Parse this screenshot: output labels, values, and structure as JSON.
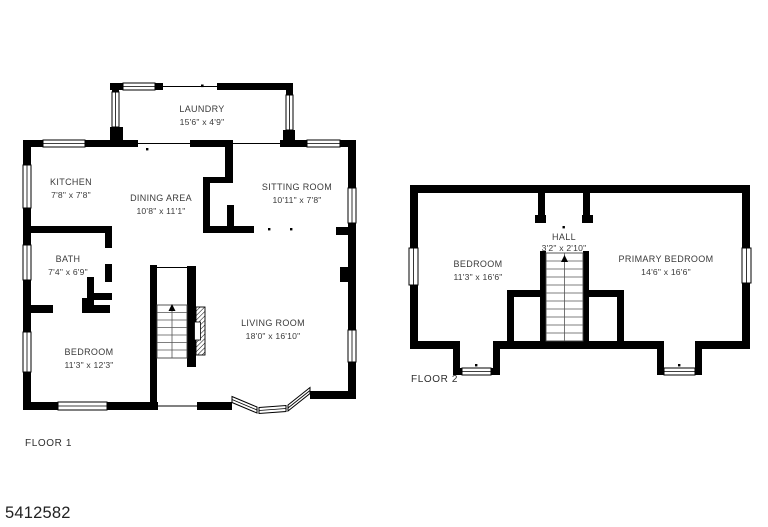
{
  "image_type": "floor-plan",
  "footer": {
    "plan_id": "5412582"
  },
  "colors": {
    "wall": "#000000",
    "text": "#3a3a3a",
    "background": "#ffffff"
  },
  "floor1": {
    "label": "FLOOR 1",
    "rooms": {
      "laundry": {
        "name": "LAUNDRY",
        "dims": "15'6\" x 4'9\""
      },
      "kitchen": {
        "name": "KITCHEN",
        "dims": "7'8\" x 7'8\""
      },
      "dining": {
        "name": "DINING AREA",
        "dims": "10'8\" x 11'1\""
      },
      "sitting": {
        "name": "SITTING ROOM",
        "dims": "10'11\" x 7'8\""
      },
      "bath": {
        "name": "BATH",
        "dims": "7'4\" x 6'9\""
      },
      "bedroom": {
        "name": "BEDROOM",
        "dims": "11'3\" x 12'3\""
      },
      "living": {
        "name": "LIVING ROOM",
        "dims": "18'0\" x 16'10\""
      }
    }
  },
  "floor2": {
    "label": "FLOOR 2",
    "rooms": {
      "bedroom": {
        "name": "BEDROOM",
        "dims": "11'3\" x 16'6\""
      },
      "hall": {
        "name": "HALL",
        "dims": "3'2\" x 2'10\""
      },
      "primary": {
        "name": "PRIMARY BEDROOM",
        "dims": "14'6\" x 16'6\""
      }
    }
  }
}
